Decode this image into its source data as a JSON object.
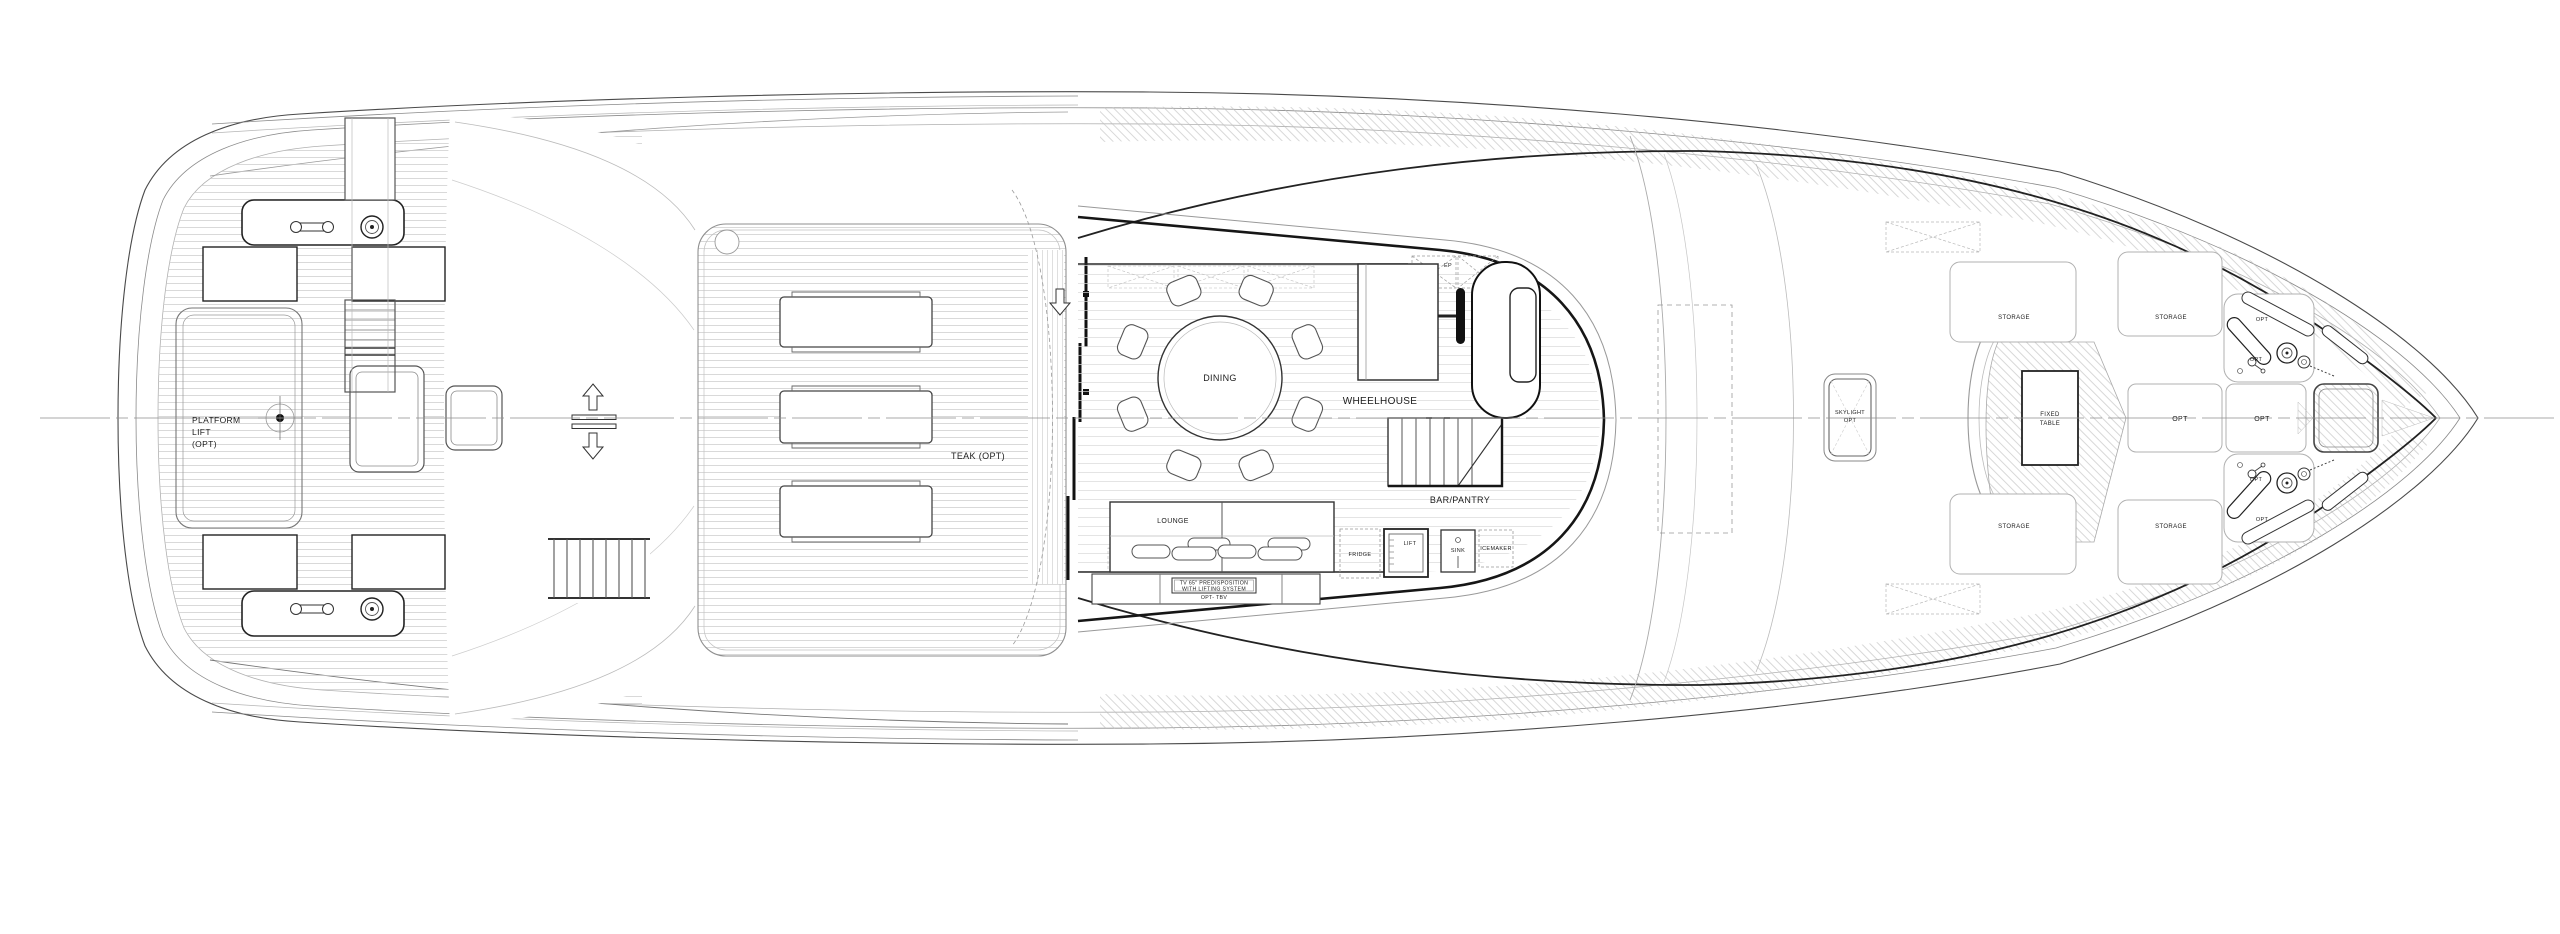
{
  "colors": {
    "background": "#ffffff",
    "line_dark": "#161616",
    "line_mid": "#555555",
    "line_light": "#aaaaaa",
    "teak_line": "#c9c9c9"
  },
  "labels": {
    "platform_lift_line1": "PLATFORM",
    "platform_lift_line2": "LIFT",
    "platform_lift_line3": "(OPT)",
    "teak_opt": "TEAK (OPT)",
    "dining": "DINING",
    "wheelhouse": "WHEELHOUSE",
    "ep": "EP",
    "bar_pantry": "BAR/PANTRY",
    "lounge": "LOUNGE",
    "tv_line1": "TV 65\" PREDISPOSITION",
    "tv_line2": "WITH LIFTING SYSTEM",
    "tv_line3": "OPT- TBV",
    "fridge": "FRIDGE",
    "lift": "LIFT",
    "sink": "SINK",
    "icemaker": "ICEMAKER",
    "skylight_line1": "SKYLIGHT",
    "skylight_line2": "OPT",
    "storage": "STORAGE",
    "fixed_table_line1": "FIXED",
    "fixed_table_line2": "TABLE",
    "opt": "OPT"
  }
}
